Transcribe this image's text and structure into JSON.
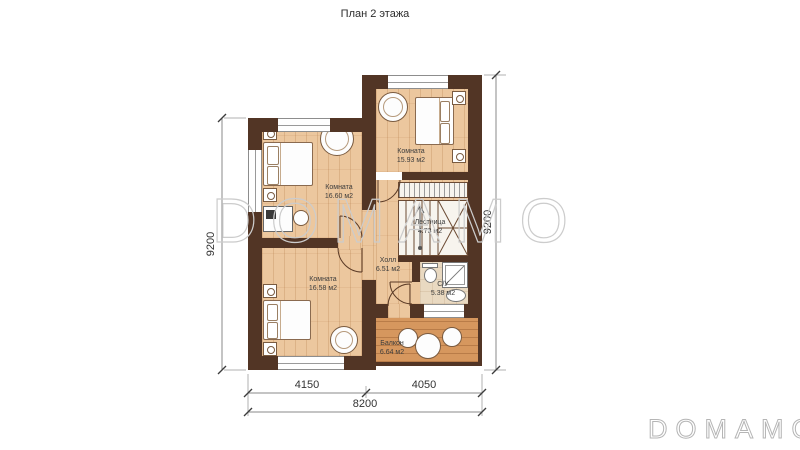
{
  "title": "План 2 этажа",
  "watermark": {
    "main": "DOMAMO",
    "corner": "DOMAMO"
  },
  "rooms": {
    "room1": {
      "name": "Комната",
      "area": "16.60 м2"
    },
    "room2": {
      "name": "Комната",
      "area": "15.93 м2"
    },
    "room3": {
      "name": "Комната",
      "area": "16.58 м2"
    },
    "hall": {
      "name": "Холл",
      "area": "6.51 м2"
    },
    "stairs": {
      "name": "Лестница",
      "area": "4.73 м2"
    },
    "bathroom": {
      "name": "С/У",
      "area": "5.38 м2"
    },
    "balcony": {
      "name": "Балкон",
      "area": "6.64 м2"
    }
  },
  "dimensions": {
    "left_height": "9200",
    "right_height": "9200",
    "bottom_left": "4150",
    "bottom_right": "4050",
    "bottom_total": "8200"
  },
  "colors": {
    "wall": "#523525",
    "floor_wood": "#ecc79e",
    "floor_balcony": "#d6975e",
    "floor_bathroom": "#e9d9c1",
    "watermark": "#cccccc"
  }
}
